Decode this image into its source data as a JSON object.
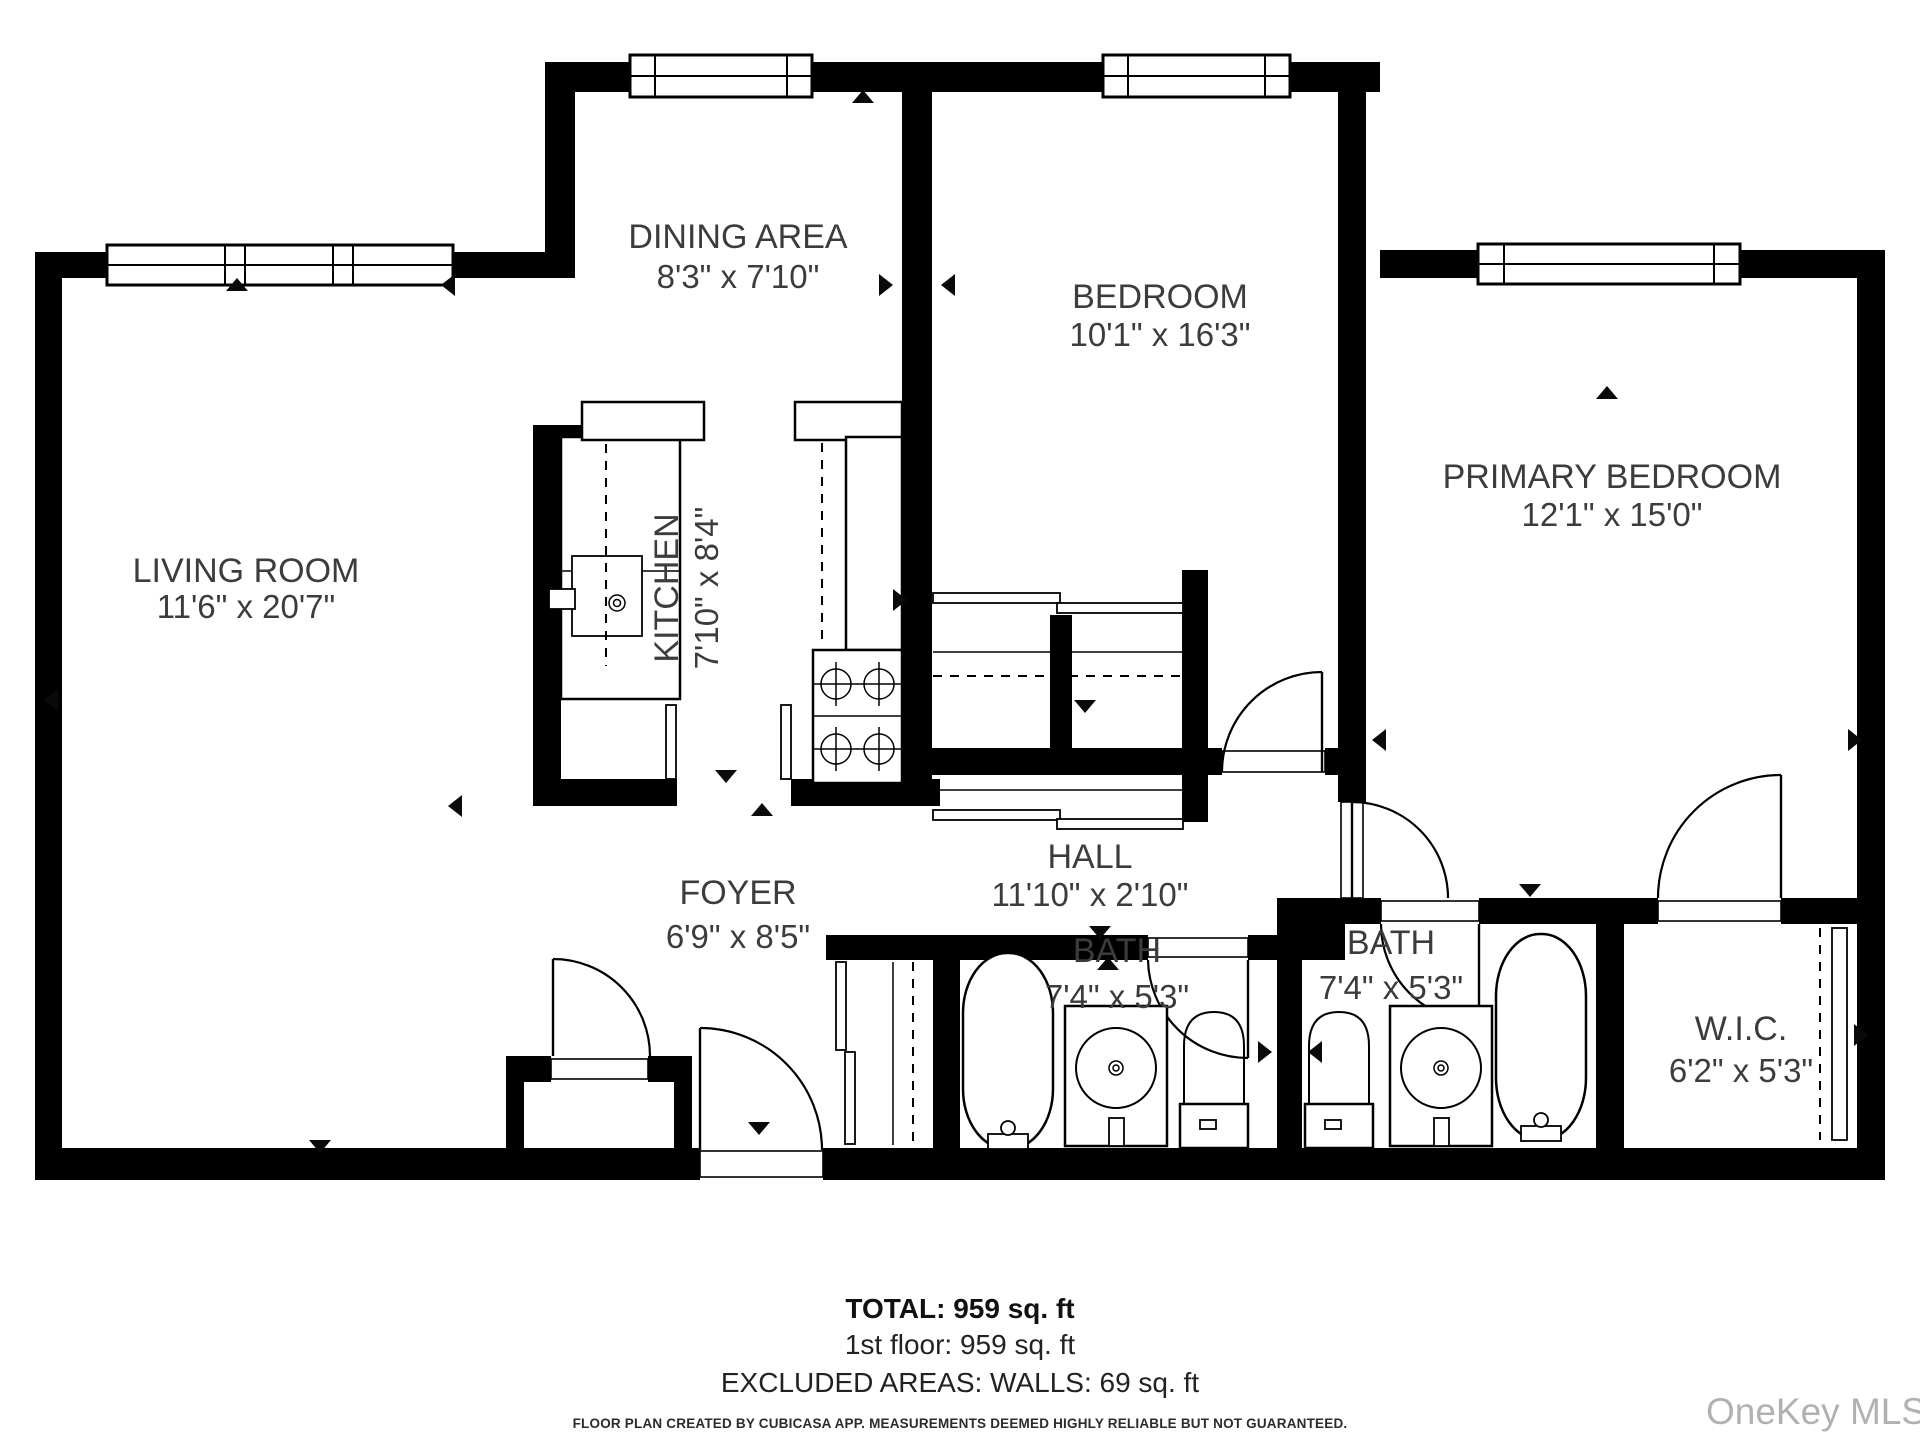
{
  "floor_plan": {
    "rooms": {
      "dining": {
        "name": "DINING AREA",
        "dims": "8'3\" x 7'10\""
      },
      "bedroom": {
        "name": "BEDROOM",
        "dims": "10'1\" x 16'3\""
      },
      "primary": {
        "name": "PRIMARY BEDROOM",
        "dims": "12'1\" x 15'0\""
      },
      "living": {
        "name": "LIVING ROOM",
        "dims": "11'6\" x 20'7\""
      },
      "kitchen": {
        "name": "KITCHEN",
        "dims": "7'10\" x 8'4\""
      },
      "hall": {
        "name": "HALL",
        "dims": "11'10\" x 2'10\""
      },
      "foyer": {
        "name": "FOYER",
        "dims": "6'9\" x 8'5\""
      },
      "bath1": {
        "name": "BATH",
        "dims": "7'4\" x 5'3\""
      },
      "bath2": {
        "name": "BATH",
        "dims": "7'4\" x 5'3\""
      },
      "wic": {
        "name": "W.I.C.",
        "dims": "6'2\" x 5'3\""
      }
    },
    "summary": {
      "total": "TOTAL: 959 sq. ft",
      "floor": "1st floor: 959 sq. ft",
      "excluded": "EXCLUDED AREAS: WALLS: 69 sq. ft"
    },
    "disclaimer": "FLOOR PLAN CREATED BY CUBICASA APP. MEASUREMENTS DEEMED HIGHLY RELIABLE BUT NOT GUARANTEED.",
    "watermark": "OneKey MLS"
  }
}
